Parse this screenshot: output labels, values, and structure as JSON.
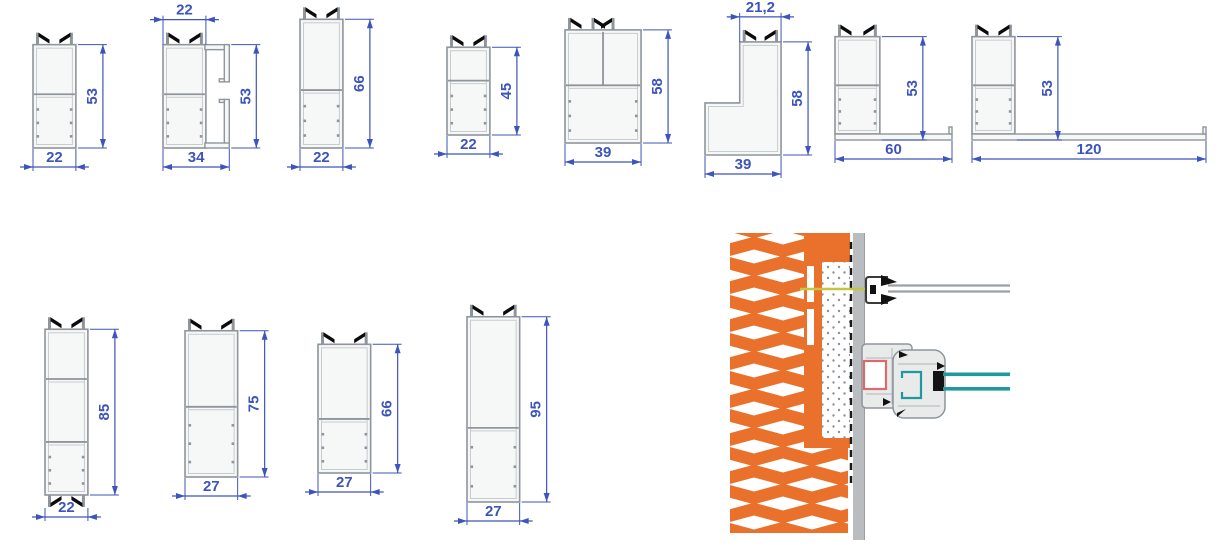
{
  "style": {
    "dim_color": "#3d54bc",
    "profile_stroke": "#8e959b",
    "profile_fill": "#f6f7f7",
    "profile_inner": "#c7cccf",
    "brush_color": "#0b0b0b",
    "mesh_orange": "#e9712b",
    "plaster_gray": "#b9bdc0",
    "glass_teal": "#1f989e",
    "reinforcement_red": "#d96b70",
    "screw_yellow": "#c6c63c",
    "scale_px_per_mm": 1.95
  },
  "profiles": [
    {
      "id": "profile-1",
      "kind": "tube",
      "x": 33,
      "y_bottom": 148,
      "width_mm": 22,
      "height_mm": 53,
      "brushes": "top",
      "dividers": [
        0.48
      ],
      "dim_right": "53",
      "dim_bottom": "22"
    },
    {
      "id": "profile-2",
      "kind": "tube-channel",
      "x": 163,
      "y_bottom": 148,
      "width_mm": 34,
      "tube_mm": 22,
      "height_mm": 53,
      "brushes": "top",
      "dividers": [
        0.48
      ],
      "dim_top": "22",
      "dim_right": "53",
      "dim_bottom": "34"
    },
    {
      "id": "profile-3",
      "kind": "tube",
      "x": 300,
      "y_bottom": 148,
      "width_mm": 22,
      "height_mm": 66,
      "brushes": "top",
      "dividers": [
        0.55
      ],
      "dim_right": "66",
      "dim_bottom": "22"
    },
    {
      "id": "profile-4",
      "kind": "tube",
      "x": 447,
      "y_bottom": 135,
      "width_mm": 22,
      "height_mm": 45,
      "brushes": "top",
      "dividers": [
        0.38
      ],
      "dim_right": "45",
      "dim_bottom": "22"
    },
    {
      "id": "profile-5",
      "kind": "wide",
      "x": 565,
      "y_bottom": 143,
      "width_mm": 39,
      "height_mm": 58,
      "brushes": "top",
      "dividers": [
        0.49
      ],
      "dim_right": "58",
      "dim_bottom": "39"
    },
    {
      "id": "profile-6",
      "kind": "step",
      "x": 705,
      "y_bottom": 155,
      "width_mm": 39,
      "top_mm": 21.2,
      "height_mm": 58,
      "brushes": "top",
      "dim_top": "21,2",
      "dim_right": "58",
      "dim_bottom": "39"
    },
    {
      "id": "profile-7",
      "kind": "flange",
      "x": 835,
      "y_bottom": 140,
      "width_mm": 60,
      "tube_mm": 23,
      "height_mm": 53,
      "brushes": "top",
      "dividers": [
        0.5
      ],
      "dim_right": "53",
      "dim_bottom": "60"
    },
    {
      "id": "profile-8",
      "kind": "flange",
      "x": 972,
      "y_bottom": 140,
      "width_mm": 120,
      "tube_mm": 22,
      "height_mm": 53,
      "brushes": "top",
      "dividers": [
        0.5
      ],
      "dim_right": "53",
      "dim_bottom": "120"
    },
    {
      "id": "profile-9",
      "kind": "tube",
      "x": 45,
      "y_bottom": 495,
      "width_mm": 22,
      "height_mm": 85,
      "brushes": "both",
      "dividers": [
        0.3,
        0.68
      ],
      "dim_right": "85",
      "dim_bottom": "22"
    },
    {
      "id": "profile-10",
      "kind": "tube",
      "x": 185,
      "y_bottom": 477,
      "width_mm": 27,
      "height_mm": 75,
      "brushes": "top",
      "dividers": [
        0.52
      ],
      "dim_right": "75",
      "dim_bottom": "27"
    },
    {
      "id": "profile-11",
      "kind": "tube",
      "x": 318,
      "y_bottom": 473,
      "width_mm": 27,
      "height_mm": 66,
      "brushes": "top",
      "dividers": [
        0.58
      ],
      "dim_right": "66",
      "dim_bottom": "27"
    },
    {
      "id": "profile-12",
      "kind": "tube",
      "x": 467,
      "y_bottom": 502,
      "width_mm": 27,
      "height_mm": 95,
      "brushes": "top",
      "dividers": [
        0.6
      ],
      "dim_right": "95",
      "dim_bottom": "27"
    }
  ],
  "detail": {
    "description": "window-to-wall installation cross-section",
    "components": {
      "wall": "perforated-brick-wall-hatch",
      "adhesive": "adhesive-layer",
      "insulation": "insulation-board",
      "membrane": "dashed-membrane-line",
      "plaster": "plaster-layer",
      "bracket": "wall-bracket",
      "rail": "support-rail",
      "screw": "fixing-screw",
      "frame": "window-frame-profile",
      "reinforcement": "steel-reinforcement",
      "sash": "sash-profile",
      "sash_reinforcement": "sash-reinforcement-channel",
      "spacer": "glazing-spacer",
      "glazing": "double-glazing-unit"
    }
  }
}
